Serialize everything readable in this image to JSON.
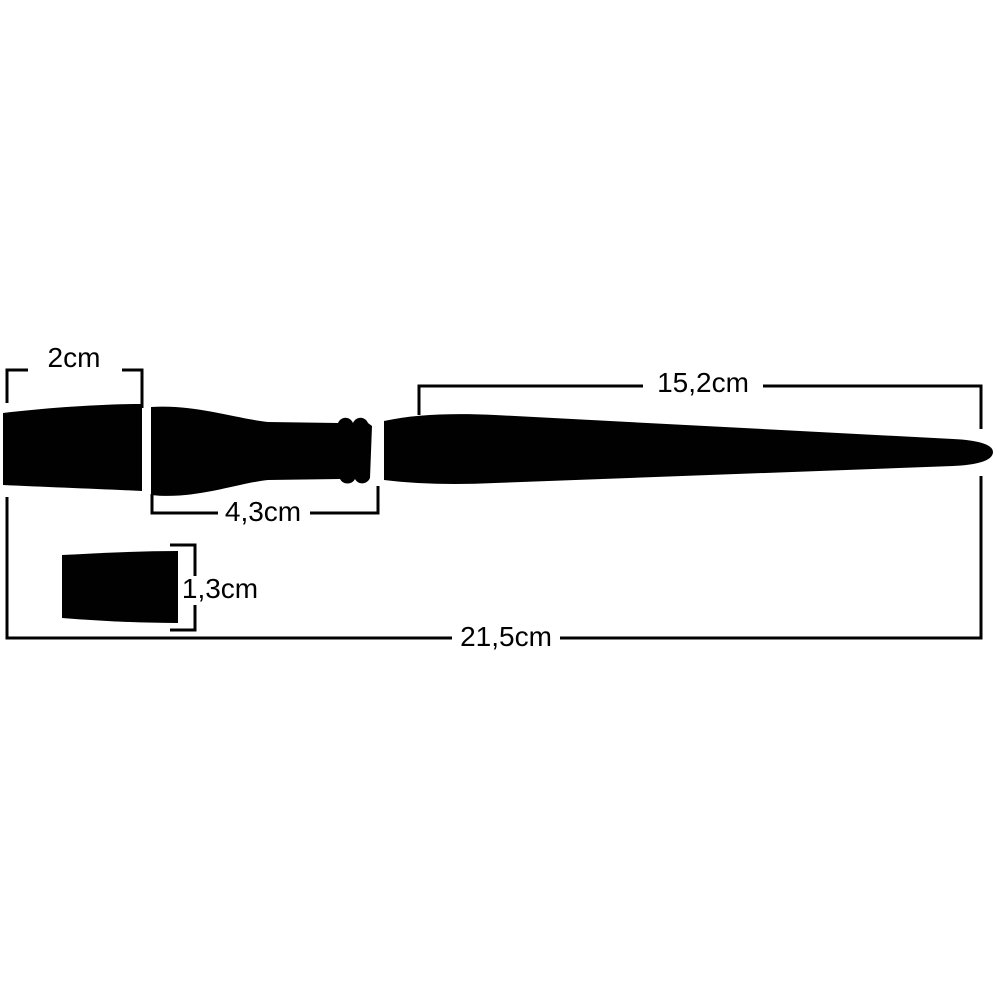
{
  "page": {
    "background_color": "#ffffff",
    "ink_color": "#010101"
  },
  "diagram": {
    "subject": "paint-brush-silhouette-with-dimensions",
    "labels": {
      "bristle_width": "2cm",
      "handle_length": "15,2cm",
      "ferrule_length": "4,3cm",
      "bristle_thickness": "1,3cm",
      "total_length": "21,5cm"
    }
  }
}
